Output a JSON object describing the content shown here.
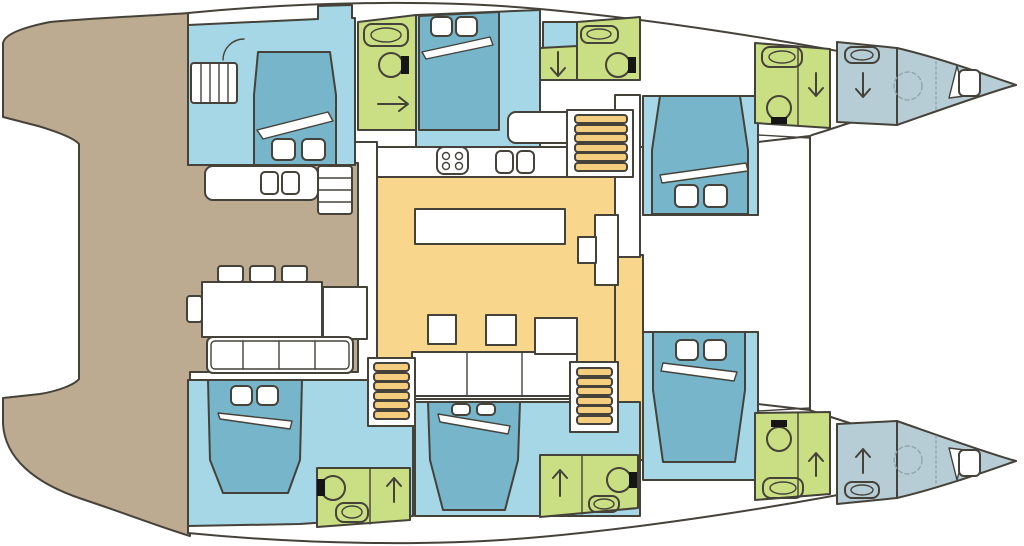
{
  "diagram": {
    "type": "catamaran-interior-floor-plan",
    "orientation": "bow-right",
    "hull_count": 2,
    "areas": [
      {
        "id": "aft-cockpit-deck",
        "color_key": "cockpit_tan"
      },
      {
        "id": "salon-galley",
        "color_key": "salon_yellow"
      },
      {
        "id": "port-aft-cabin",
        "color_key": "cabin_blue"
      },
      {
        "id": "port-mid-cabin",
        "color_key": "cabin_blue"
      },
      {
        "id": "port-fwd-cabin",
        "color_key": "cabin_blue"
      },
      {
        "id": "starboard-aft-cabin",
        "color_key": "cabin_blue"
      },
      {
        "id": "starboard-mid-cabin",
        "color_key": "cabin_blue"
      },
      {
        "id": "starboard-fwd-cabin",
        "color_key": "cabin_blue"
      },
      {
        "id": "port-aft-head",
        "color_key": "bathroom_green"
      },
      {
        "id": "port-mid-head",
        "color_key": "bathroom_green"
      },
      {
        "id": "port-fwd-head",
        "color_key": "bathroom_green"
      },
      {
        "id": "starboard-aft-head",
        "color_key": "bathroom_green"
      },
      {
        "id": "starboard-mid-head",
        "color_key": "bathroom_green"
      },
      {
        "id": "starboard-fwd-head",
        "color_key": "bathroom_green"
      },
      {
        "id": "port-bow-shower",
        "color_key": "forepeak_gray"
      },
      {
        "id": "starboard-bow-shower",
        "color_key": "forepeak_gray"
      },
      {
        "id": "port-forepeak",
        "color_key": "forepeak_gray"
      },
      {
        "id": "starboard-forepeak",
        "color_key": "forepeak_gray"
      },
      {
        "id": "foredeck",
        "color_key": "deck_white"
      }
    ],
    "icons": [
      "bed",
      "pillow",
      "duvet-fold",
      "toilet",
      "sink",
      "shower-arrow",
      "stove-burners",
      "double-sink",
      "stairs",
      "dining-table",
      "sofa",
      "chair",
      "nav-desk",
      "door-arc",
      "optional-fixture-dashed-circle",
      "bow-berth"
    ]
  },
  "palette": {
    "outline": "#45423a",
    "deck_white": "#ffffff",
    "cockpit_tan": "#bcab90",
    "cabin_blue": "#a6d7e6",
    "bed_blue": "#76b5ca",
    "bathroom_green": "#cade83",
    "salon_yellow": "#f8d78c",
    "stairs_yellow": "#f5cd7e",
    "forepeak_gray": "#b7cdd6",
    "toilet_black": "#151515",
    "dashed_gray": "#8fa6ad"
  }
}
